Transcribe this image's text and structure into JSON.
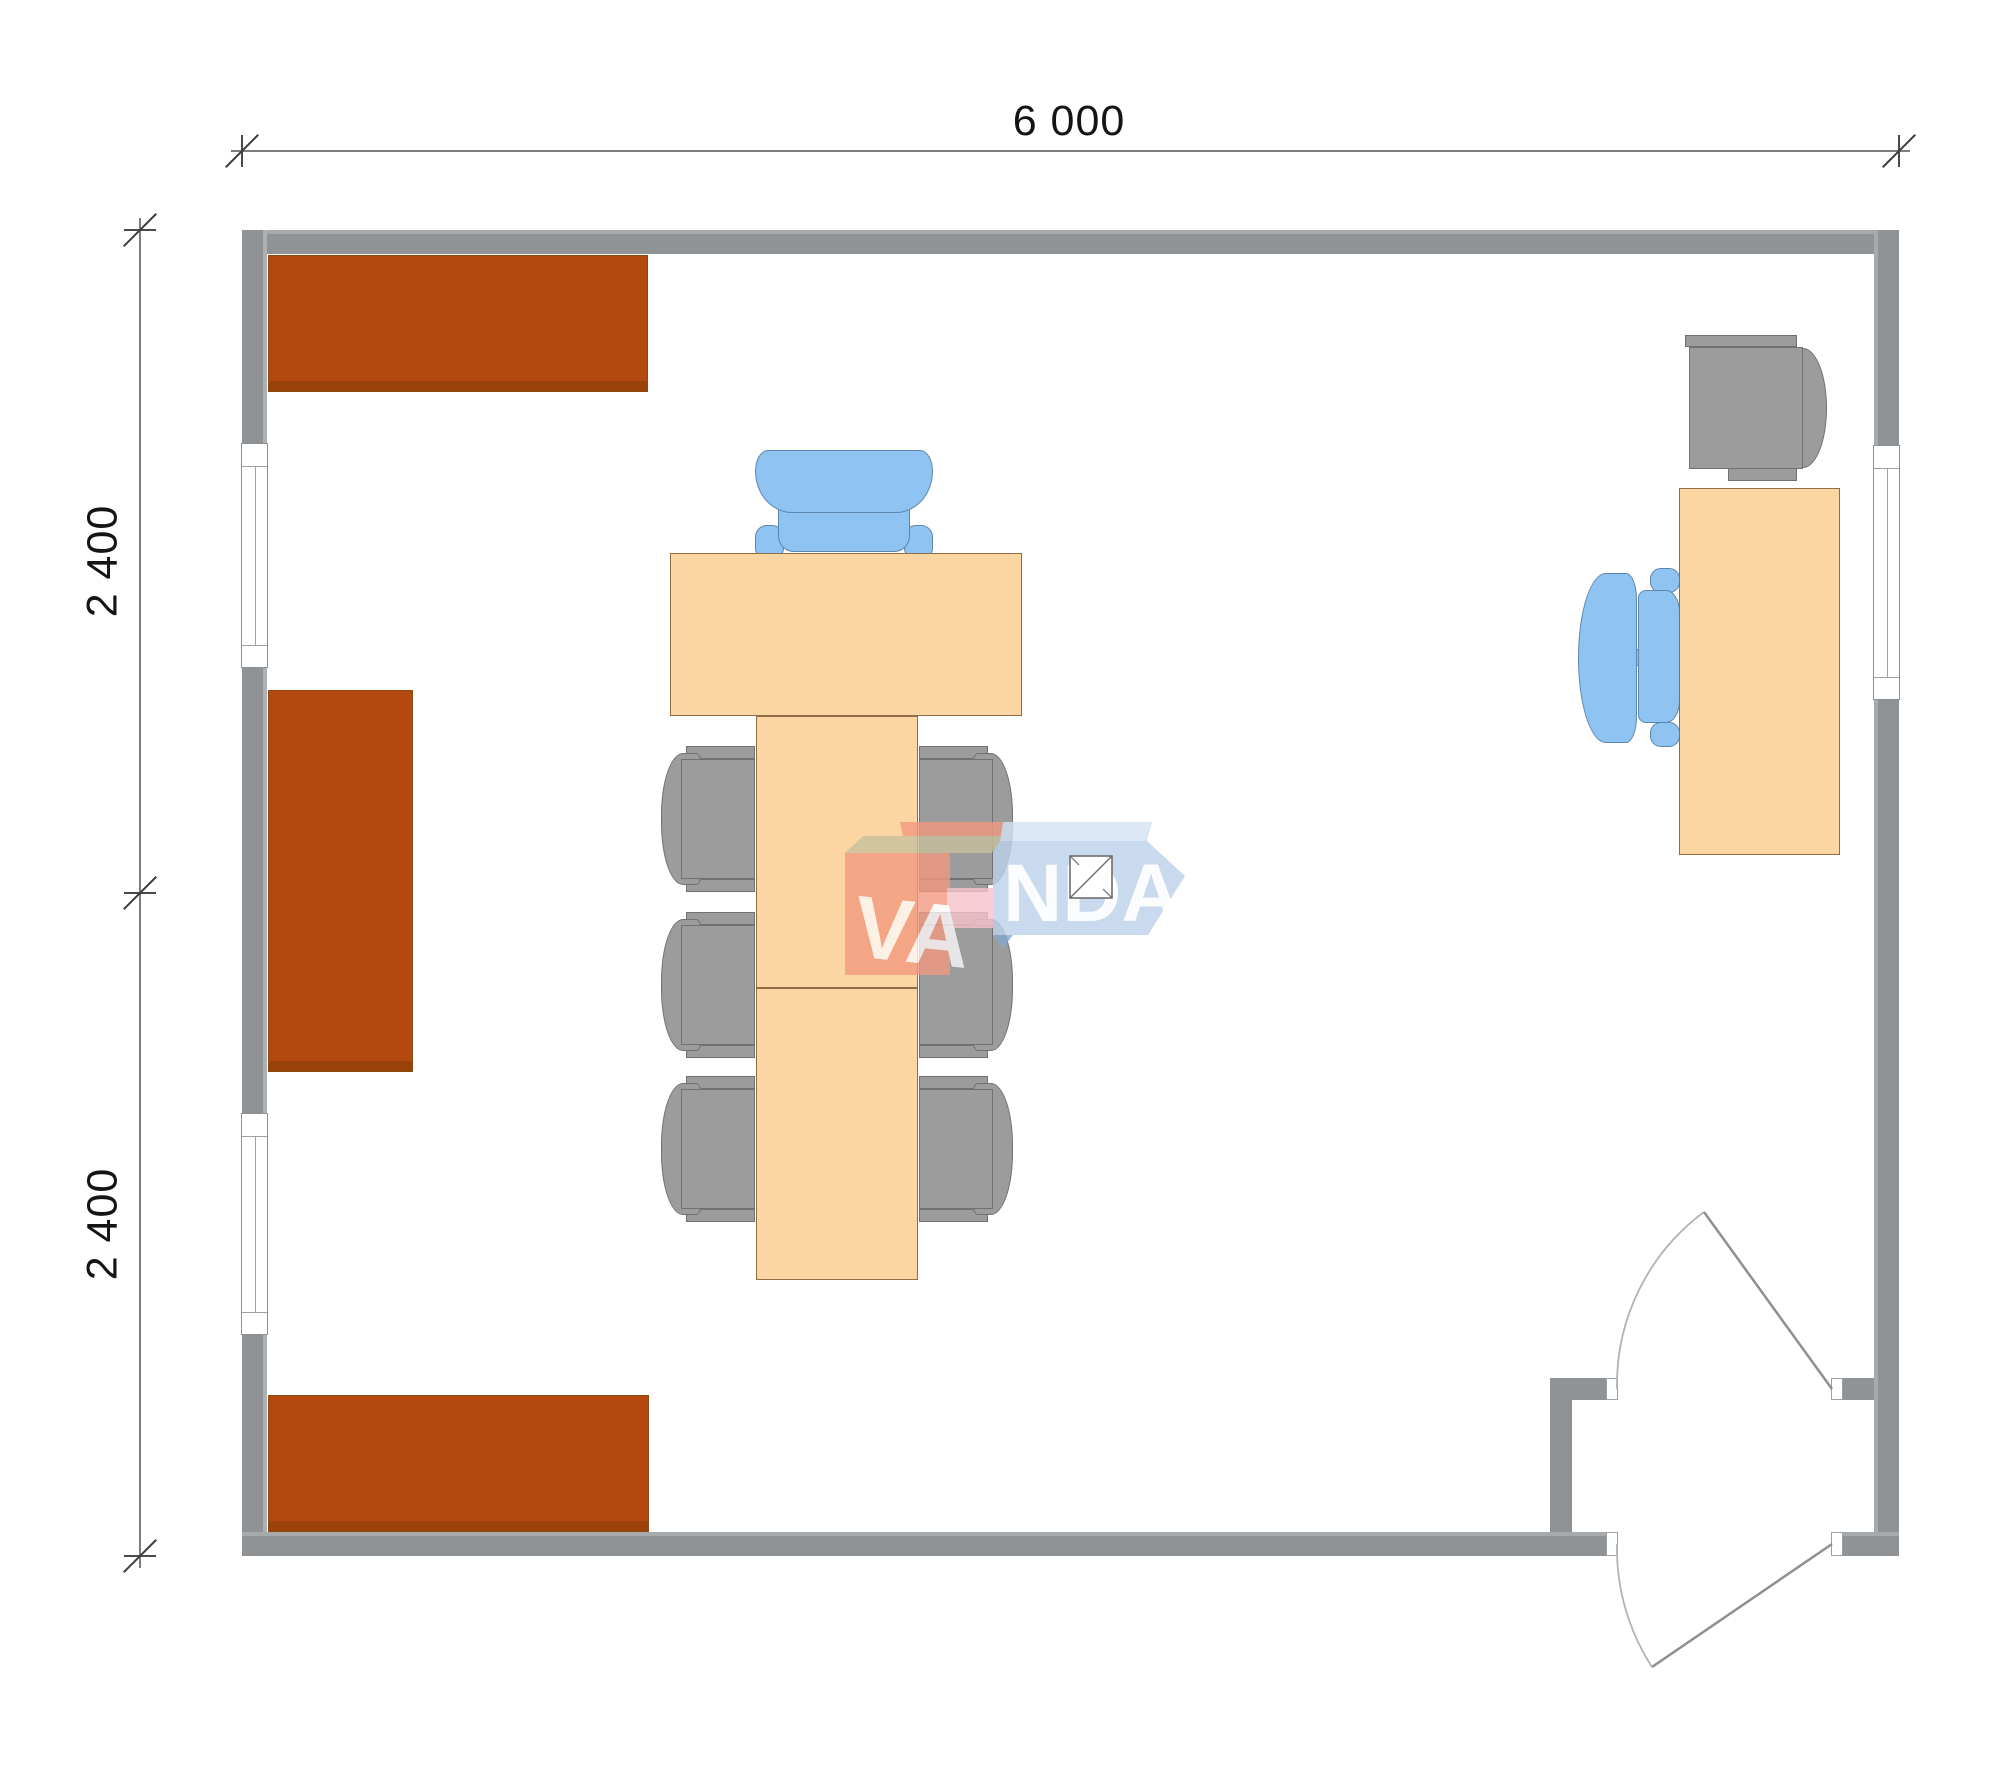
{
  "title": "office-floor-plan",
  "dimensions": {
    "width_total": "6 000",
    "height_top": "2 400",
    "height_bottom": "2 400"
  },
  "watermark": {
    "brand": "VANDA",
    "text_va": "VA",
    "text_nda": "NDA"
  },
  "colors": {
    "wall": "#8F9396",
    "cabinet_brown": "#B3490E",
    "table_wood": "#FBD6A2",
    "chair_gray": "#9C9C9C",
    "chair_blue": "#8FC4F2",
    "dimension_text": "#141414",
    "watermark_salmon": "#F2997F",
    "watermark_tan": "#C9C09C",
    "watermark_blue": "#BCD2EA",
    "watermark_pink": "#F6C3CA"
  },
  "elements": {
    "room": "main office 6000 x 4800 mm",
    "furniture": [
      "wall cabinet top-left",
      "wall cabinet middle-left",
      "wall cabinet bottom-left",
      "conference head table",
      "conference table extension",
      "executive blue chair",
      "six gray conference chairs",
      "office desk right",
      "gray desk chair",
      "blue desk chair"
    ],
    "openings": [
      "window left upper",
      "window left lower",
      "window right",
      "inner door with swing arc",
      "entrance door with swing arc"
    ]
  }
}
